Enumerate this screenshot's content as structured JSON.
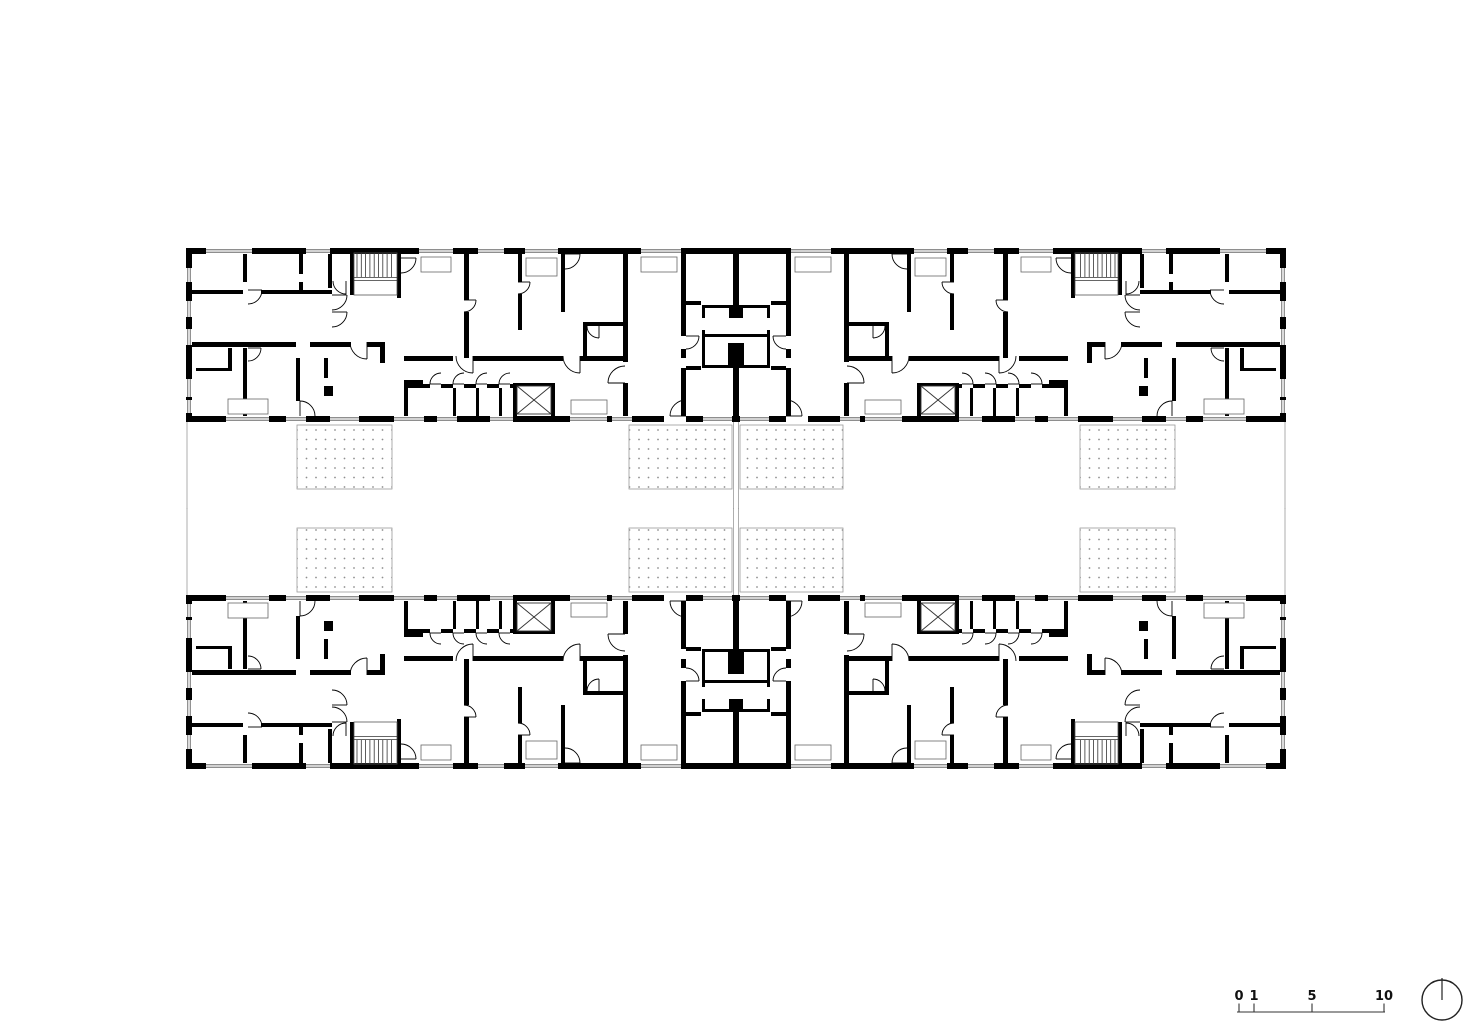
{
  "canvas": {
    "w": 1473,
    "h": 1028,
    "bg": "#ffffff",
    "ink": "#000000",
    "thin": "#4a4a4a",
    "pale": "#9a9a9a"
  },
  "plan": {
    "outer": {
      "x": 186,
      "y": 248,
      "w": 1100,
      "h": 174,
      "wall": 6,
      "center_x": 736,
      "mirror_y": 508.5
    },
    "walls": [
      [
        243,
        254,
        4,
        28
      ],
      [
        299,
        254,
        4,
        20
      ],
      [
        299,
        282,
        4,
        10
      ],
      [
        328,
        254,
        4,
        34
      ],
      [
        192,
        290,
        51,
        4
      ],
      [
        261,
        290,
        71,
        4
      ],
      [
        350,
        254,
        4,
        41
      ],
      [
        397,
        254,
        4,
        44
      ],
      [
        464,
        254,
        5,
        46
      ],
      [
        464,
        312,
        5,
        46
      ],
      [
        518,
        254,
        4,
        28
      ],
      [
        518,
        294,
        4,
        36
      ],
      [
        561,
        254,
        4,
        58
      ],
      [
        192,
        342,
        104,
        5
      ],
      [
        310,
        342,
        41,
        5
      ],
      [
        367,
        342,
        18,
        5
      ],
      [
        380,
        342,
        5,
        21
      ],
      [
        404,
        356,
        49,
        5
      ],
      [
        473,
        356,
        90,
        5
      ],
      [
        580,
        356,
        43,
        5
      ],
      [
        623,
        254,
        5,
        108
      ],
      [
        623,
        383,
        5,
        33
      ],
      [
        681,
        248,
        5,
        88
      ],
      [
        681,
        349,
        5,
        9
      ],
      [
        681,
        368,
        5,
        48
      ],
      [
        733,
        248,
        6,
        59
      ],
      [
        733,
        368,
        6,
        54
      ],
      [
        404,
        380,
        19,
        8
      ],
      [
        404,
        388,
        4,
        28
      ],
      [
        423,
        384,
        7,
        4
      ],
      [
        441,
        384,
        12,
        4
      ],
      [
        464,
        384,
        12,
        4
      ],
      [
        487,
        384,
        12,
        4
      ],
      [
        510,
        384,
        3,
        4
      ],
      [
        453,
        388,
        3,
        28
      ],
      [
        476,
        388,
        3,
        28
      ],
      [
        499,
        388,
        3,
        28
      ],
      [
        513,
        383,
        4,
        33
      ],
      [
        551,
        383,
        4,
        33
      ],
      [
        513,
        383,
        42,
        3
      ],
      [
        243,
        348,
        4,
        68
      ],
      [
        296,
        358,
        4,
        43
      ],
      [
        324,
        358,
        4,
        20
      ],
      [
        324,
        386,
        9,
        10
      ],
      [
        228,
        348,
        4,
        22
      ],
      [
        196,
        368,
        36,
        3
      ],
      [
        583,
        322,
        42,
        4
      ],
      [
        583,
        326,
        4,
        30
      ],
      [
        686,
        301,
        15,
        4
      ],
      [
        686,
        366,
        15,
        4
      ],
      [
        702,
        305,
        3,
        13
      ],
      [
        702,
        330,
        3,
        38
      ],
      [
        702,
        305,
        34,
        3
      ],
      [
        702,
        334,
        34,
        3
      ],
      [
        702,
        365,
        34,
        3
      ],
      [
        729,
        305,
        14,
        13
      ],
      [
        728,
        343,
        16,
        25
      ]
    ],
    "stairs": {
      "x": 354,
      "y": 253,
      "w": 43,
      "h": 42,
      "tread_depth": 24,
      "tread_step": 4.3
    },
    "elevator": {
      "x": 517,
      "y": 386,
      "w": 34,
      "h": 28
    },
    "windows_top": [
      [
        206,
        46
      ],
      [
        306,
        24
      ],
      [
        419,
        34
      ],
      [
        478,
        26
      ],
      [
        525,
        33
      ],
      [
        641,
        44
      ]
    ],
    "windows_bottom": [
      [
        226,
        43
      ],
      [
        286,
        20
      ],
      [
        330,
        29
      ],
      [
        394,
        30
      ],
      [
        437,
        20
      ],
      [
        490,
        23
      ],
      [
        570,
        37
      ],
      [
        612,
        20
      ],
      [
        703,
        29
      ]
    ],
    "windows_left": [
      [
        268,
        14
      ],
      [
        301,
        16
      ],
      [
        329,
        16
      ],
      [
        379,
        18
      ],
      [
        400,
        13
      ]
    ],
    "entry_door_bottom": [
      664,
      22
    ],
    "sills": [
      [
        421,
        257,
        30,
        15
      ],
      [
        526,
        258,
        31,
        18
      ],
      [
        641,
        257,
        36,
        15
      ],
      [
        571,
        400,
        36,
        14
      ],
      [
        228,
        399,
        40,
        15
      ]
    ],
    "door_arcs": [
      [
        248,
        290,
        14,
        0
      ],
      [
        367,
        342,
        17,
        1
      ],
      [
        346,
        281,
        13,
        1
      ],
      [
        332,
        295,
        15,
        0
      ],
      [
        332,
        312,
        15,
        0
      ],
      [
        401,
        258,
        15,
        0
      ],
      [
        464,
        300,
        12,
        0
      ],
      [
        518,
        282,
        12,
        0
      ],
      [
        565,
        254,
        15,
        0
      ],
      [
        599,
        326,
        12,
        1
      ],
      [
        473,
        356,
        17,
        1
      ],
      [
        580,
        356,
        17,
        1
      ],
      [
        625,
        383,
        17,
        2
      ],
      [
        441,
        384,
        11,
        2
      ],
      [
        464,
        384,
        11,
        2
      ],
      [
        487,
        384,
        11,
        2
      ],
      [
        510,
        384,
        11,
        2
      ],
      [
        686,
        416,
        16,
        2
      ],
      [
        300,
        416,
        15,
        3
      ],
      [
        248,
        348,
        13,
        0
      ],
      [
        686,
        336,
        13,
        0
      ]
    ]
  },
  "courtyard": {
    "patios": [
      [
        297,
        425,
        95,
        64
      ],
      [
        629,
        425,
        103,
        64
      ]
    ],
    "boundary_lines": [
      [
        187,
        422,
        187,
        509
      ],
      [
        733.5,
        422,
        733.5,
        509
      ]
    ],
    "dot_color": "#8f8f8f",
    "outline_color": "#9a9a9a"
  },
  "scalebar": {
    "labels": [
      "0",
      "1",
      "5",
      "10"
    ],
    "tick_x": [
      1239,
      1254,
      1312,
      1384
    ],
    "bar": {
      "x1": 1237,
      "x2": 1385,
      "y": 1012
    },
    "tick_top": 1003.5,
    "label_baseline": 1000,
    "font_size": 13
  },
  "north_indicator": {
    "cx": 1442,
    "cy": 1000,
    "r": 20
  }
}
